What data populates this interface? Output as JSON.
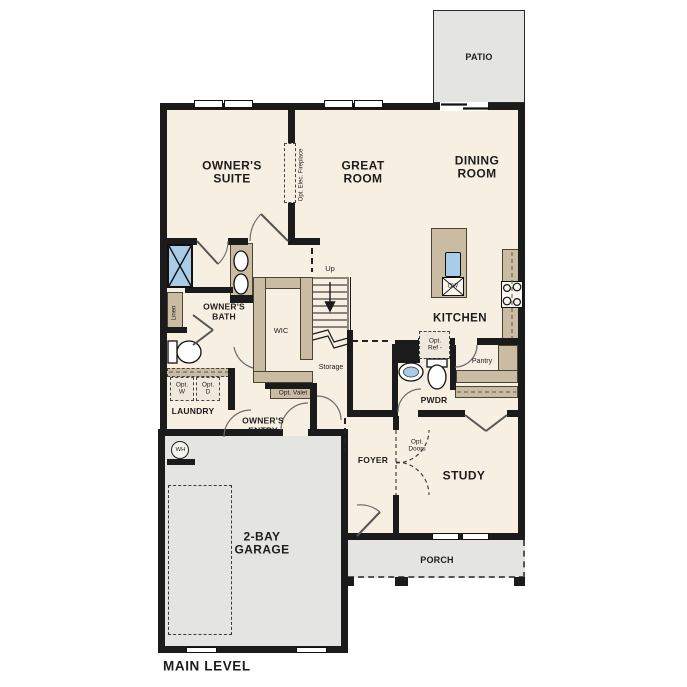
{
  "plan_title": "MAIN LEVEL",
  "colors": {
    "floor": "#f7efe2",
    "outdoor": "#e4e4e2",
    "cabinet": "#c9bca3",
    "water": "#a9cde8",
    "wall": "#1b1b1b"
  },
  "rooms": {
    "patio": "PATIO",
    "owners_suite": "OWNER'S\nSUITE",
    "great_room": "GREAT\nROOM",
    "dining_room": "DINING\nROOM",
    "kitchen": "KITCHEN",
    "owners_bath": "OWNER'S\nBATH",
    "wic": "WIC",
    "laundry": "LAUNDRY",
    "owners_entry": "OWNER'S\nENTRY",
    "foyer": "FOYER",
    "pwdr": "PWDR",
    "study": "STUDY",
    "pantry": "Pantry",
    "storage": "Storage",
    "garage": "2-BAY\nGARAGE",
    "porch": "PORCH"
  },
  "annotations": {
    "up": "Up",
    "linen": "Linen",
    "opt_elec_fireplace": "Opt. Elec. Fireplace",
    "opt_washer": "Opt.\nW",
    "opt_dryer": "Opt.\nD",
    "opt_valet": "Opt. Valet",
    "opt_ref": "Opt.\nRef -",
    "opt_doors": "Opt.\nDoors",
    "dw": "DW",
    "wh": "WH"
  }
}
